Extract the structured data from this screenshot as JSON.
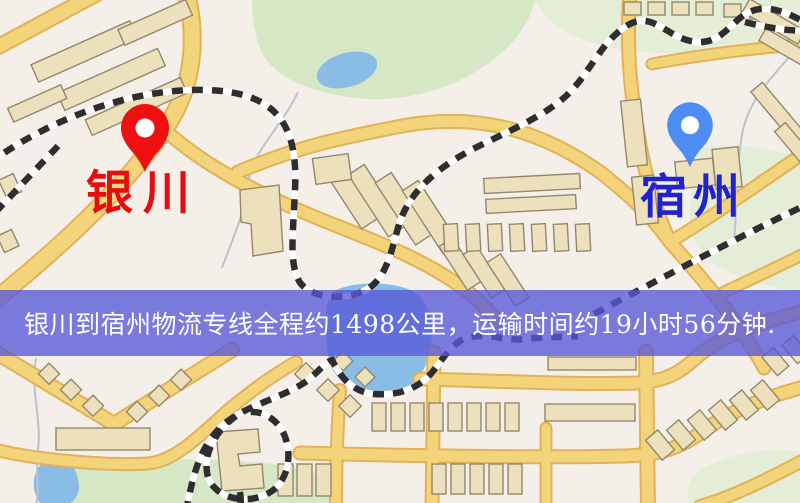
{
  "banner": {
    "text": "银川到宿州物流专线全程约1498公里，运输时间约19小时56分钟."
  },
  "route": {
    "origin": "银川",
    "destination": "宿州",
    "distance_text": "约1498公里",
    "duration_text": "约19小时56分钟"
  },
  "markers": {
    "origin": {
      "label": "银川"
    },
    "destination": {
      "label": "宿州"
    }
  },
  "theme": {
    "map_bg": "#f5efe9",
    "road_fill": "#f3d47a",
    "road_casing": "#e2b258",
    "building_fill": "#ede1bd",
    "building_stroke": "#93876d",
    "park_fill": "#d6e7c5",
    "park_pale": "#e4eed6",
    "water_fill": "#8abde6",
    "stream": "#b9c5cd",
    "rail_dark": "#2e2e2e",
    "rail_light": "#ffffff",
    "banner_bg": "#5757d8",
    "banner_text": "#ffffff",
    "origin_pin": "#ee1010",
    "origin_label": "#e80d0d",
    "dest_pin": "#4d8df2",
    "dest_label": "#2323cd"
  }
}
